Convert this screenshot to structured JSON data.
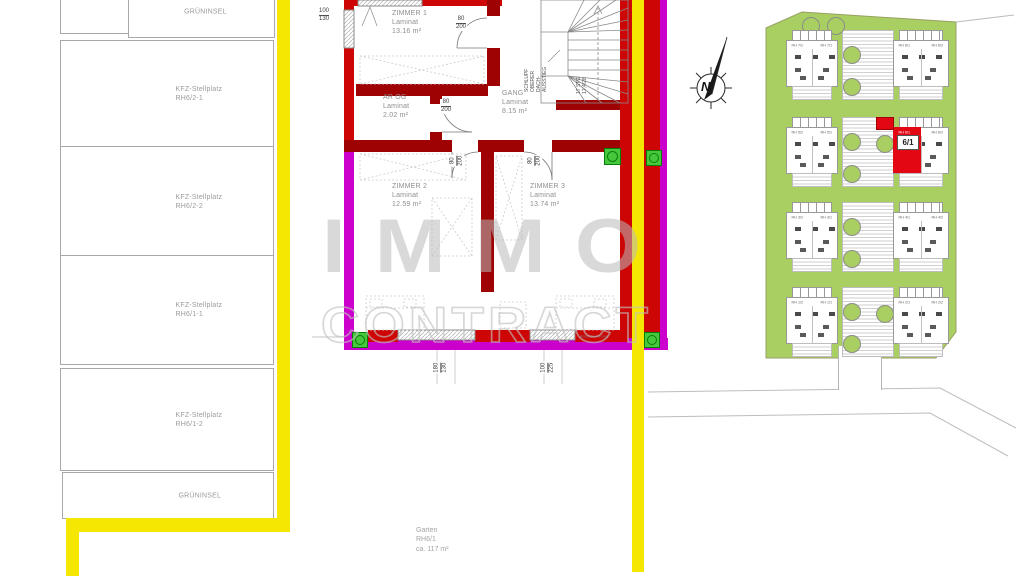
{
  "parking": {
    "items": [
      {
        "line1": "GRÜNINSEL",
        "line2": ""
      },
      {
        "line1": "KFZ-Stellplatz",
        "line2": "RH6/2-1"
      },
      {
        "line1": "KFZ-Stellplatz",
        "line2": "RH6/2-2"
      },
      {
        "line1": "KFZ-Stellplatz",
        "line2": "RH6/1-1"
      },
      {
        "line1": "KFZ-Stellplatz",
        "line2": "RH6/1-2"
      },
      {
        "line1": "GRÜNINSEL",
        "line2": ""
      }
    ]
  },
  "floorplan": {
    "rooms": [
      {
        "name": "ZIMMER 1",
        "floor": "Laminat",
        "area": "13.16 m²"
      },
      {
        "name": "AR OG",
        "floor": "Laminat",
        "area": "2.02 m²"
      },
      {
        "name": "GANG",
        "floor": "Laminat",
        "area": "8.15 m²"
      },
      {
        "name": "ZIMMER 2",
        "floor": "Laminat",
        "area": "12.59 m²"
      },
      {
        "name": "ZIMMER 3",
        "floor": "Laminat",
        "area": "13.74 m²"
      }
    ],
    "dims": {
      "window_left_top": {
        "w": "100",
        "h": "130"
      },
      "door": {
        "w": "80",
        "h": "200"
      },
      "window_bottom": {
        "w": "180",
        "h": "130"
      },
      "door_bottom": {
        "w": "100",
        "h": "225"
      }
    },
    "stair_steps_line1": "17 STG",
    "stair_steps_line2": "17,4/28",
    "stair_note": {
      "l1": "SCHLUPF",
      "l2": "OBERER",
      "l3": "DACH-",
      "l4": "AUSSTIEG"
    },
    "window_note": "Absturzsicherung"
  },
  "site": {
    "blocks": [
      {
        "left": "RH 7/2",
        "right": "RH 7/1"
      },
      {
        "left": "RH 8/1",
        "right": "RH 8/2"
      },
      {
        "left": "RH 5/2",
        "right": "RH 5/1"
      },
      {
        "left": "RH 6/1",
        "right": "RH 6/2"
      },
      {
        "left": "RH 3/2",
        "right": "RH 3/1"
      },
      {
        "left": "RH 4/1",
        "right": "RH 4/2"
      },
      {
        "left": "RH 1/2",
        "right": "RH 1/1"
      },
      {
        "left": "RH 2/1",
        "right": "RH 2/2"
      }
    ],
    "highlight_label": "6/1"
  },
  "garden": {
    "line1": "Garten",
    "line2": "RH6/1",
    "line3": "ca. 117 m²"
  },
  "north": {
    "label": "N"
  },
  "watermark": {
    "line1": "IMMO",
    "line2": "CONTRACT"
  },
  "colors": {
    "wall_red": "#CE0505",
    "wall_magenta": "#CC00CC",
    "boundary_yellow": "#F6E703",
    "site_green": "#A9CE62",
    "highlight_red": "#E30613",
    "marker_green": "#46C83C"
  }
}
